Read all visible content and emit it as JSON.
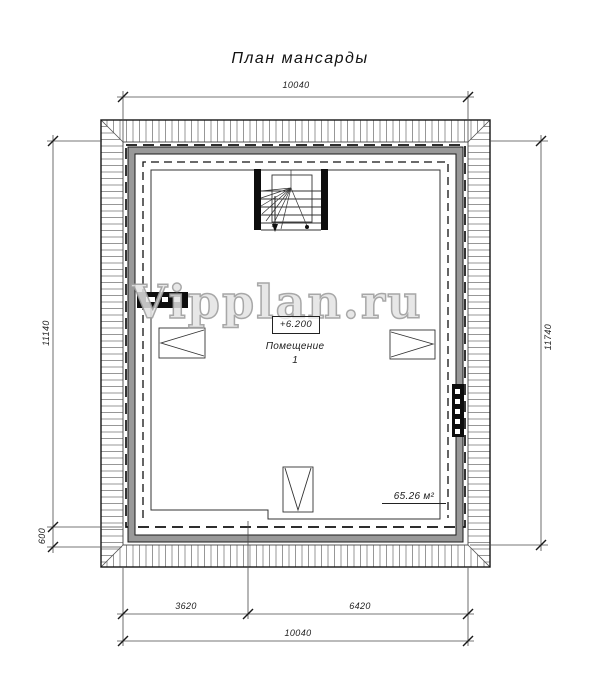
{
  "title": {
    "text": "План мансарды"
  },
  "watermark": {
    "text": "Vipplan.ru"
  },
  "dimensions": {
    "top_total": "10040",
    "left_height": "11140",
    "left_eave": "600",
    "right_height": "11740",
    "bottom_left": "3620",
    "bottom_right": "6420",
    "bottom_total": "10040"
  },
  "room": {
    "elevation_mark": "+6.200",
    "name": "Помещение",
    "number": "1",
    "area": "65.26 м²"
  },
  "symbols": {
    "stairs": "winder-staircase-with-down-arrow",
    "window_left": "triangle-window-symbol-left",
    "window_right": "triangle-window-symbol-right",
    "window_bottom": "triangle-window-symbol-down",
    "flue_left": "black-flue-block-horizontal",
    "flue_right": "black-flue-block-vertical"
  },
  "colors": {
    "line": "#222222",
    "hatch": "#666666",
    "wall_band": "#999999",
    "dimension_line": "#444444",
    "watermark_fill": "#ffffff",
    "watermark_stroke": "#9b9b9b"
  }
}
